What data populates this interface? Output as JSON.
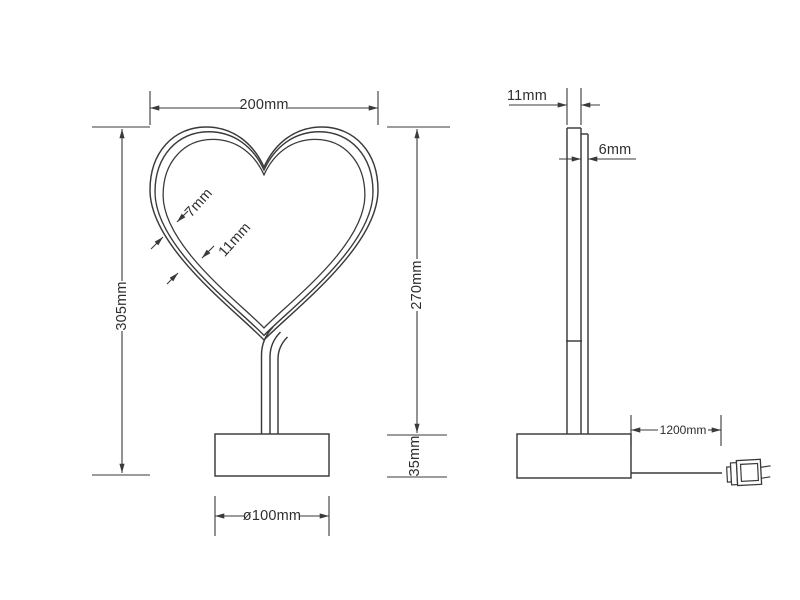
{
  "drawing_title": "heart-neon-lamp-dimension-drawing",
  "front_view": {
    "width": "200mm",
    "total_height": "305mm",
    "heart_height": "270mm",
    "base_height": "35mm",
    "base_diameter": "ø100mm",
    "tube_inner_width": "7mm",
    "tube_outer_width": "11mm"
  },
  "side_view": {
    "depth": "11mm",
    "panel_thickness": "6mm",
    "cable_length": "1200mm"
  },
  "colors": {
    "line": "#3a3a3a",
    "text": "#2e2e2e",
    "background": "#ffffff"
  }
}
